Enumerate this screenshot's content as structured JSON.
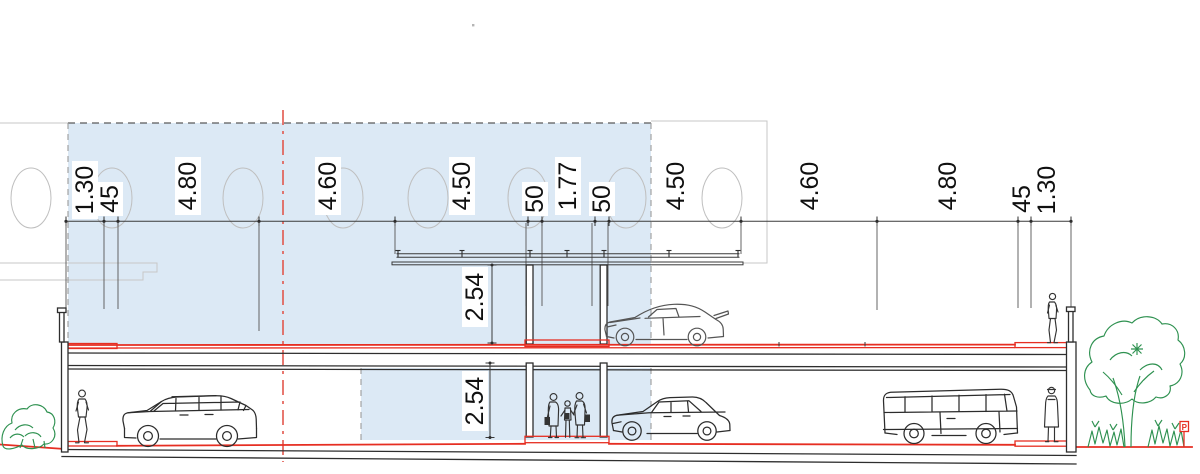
{
  "dimensions": {
    "horizontal": [
      "1.30",
      "45",
      "4.80",
      "4.60",
      "4.50",
      "50",
      "1.77",
      "50",
      "4.50",
      "4.60",
      "4.80",
      "45",
      "1.30"
    ],
    "vertical": [
      "2.54",
      "2.54"
    ]
  },
  "signs": {
    "parking": "P"
  },
  "figures": {
    "zone": "proposed-section-highlight-zone",
    "vehicles": [
      "station-wagon-car",
      "sports-car",
      "hatchback-car",
      "minibus-van"
    ],
    "people": [
      "pedestrian-left",
      "pedestrian-group",
      "pedestrian-upper-deck",
      "pedestrian-right"
    ],
    "landscape": [
      "shrub-left",
      "tree-right",
      "shrubs-right",
      "parking-sign"
    ]
  },
  "colors": {
    "zone_fill": "#dce9f5",
    "red_line": "#e62e22",
    "centerline_red": "#e2574d",
    "green": "#2e9150",
    "line_dark": "#2e2e2e",
    "line_faint": "#c7c7c7"
  }
}
